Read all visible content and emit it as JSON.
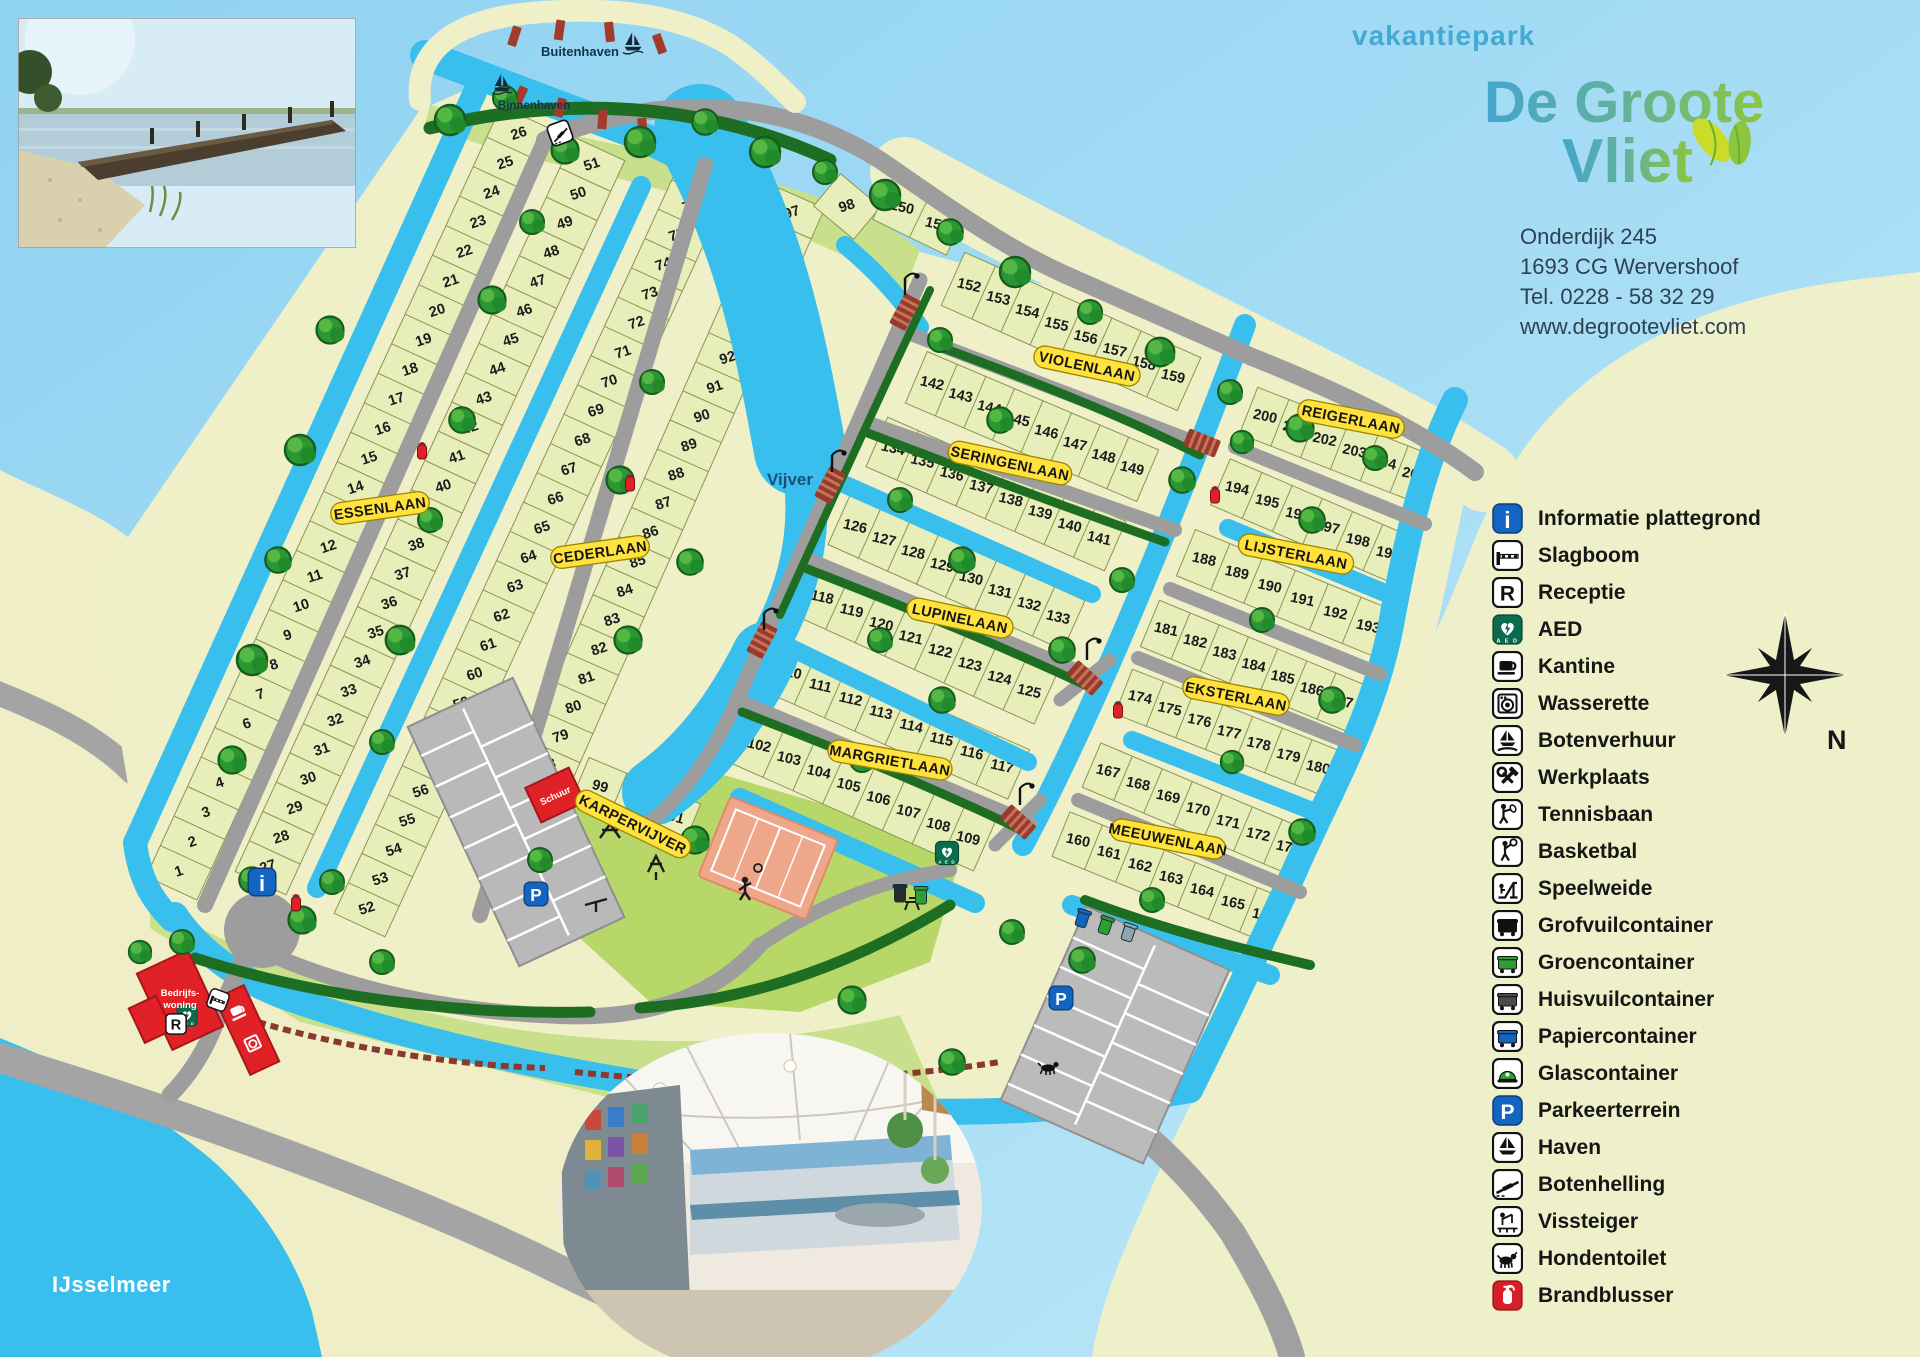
{
  "header": {
    "brand_top": "vakantiepark",
    "brand_line1": "De Groote",
    "brand_line2": "Vliet",
    "address": [
      "Onderdijk 245",
      "1693 CG  Wervershoof",
      "Tel. 0228 - 58 32 29",
      "www.degrootevliet.com"
    ]
  },
  "legend": {
    "compass_label": "N",
    "items": [
      {
        "icon": "info-icon",
        "label": "Informatie plattegrond"
      },
      {
        "icon": "barrier-icon",
        "label": "Slagboom"
      },
      {
        "icon": "reception-icon",
        "label": "Receptie"
      },
      {
        "icon": "aed-icon",
        "label": "AED"
      },
      {
        "icon": "canteen-icon",
        "label": "Kantine"
      },
      {
        "icon": "laundry-icon",
        "label": "Wasserette"
      },
      {
        "icon": "boat-rental-icon",
        "label": "Botenverhuur"
      },
      {
        "icon": "workshop-icon",
        "label": "Werkplaats"
      },
      {
        "icon": "tennis-icon",
        "label": "Tennisbaan"
      },
      {
        "icon": "basketball-icon",
        "label": "Basketbal"
      },
      {
        "icon": "playfield-icon",
        "label": "Speelweide"
      },
      {
        "icon": "bulky-waste-icon",
        "label": "Grofvuilcontainer"
      },
      {
        "icon": "green-container-icon",
        "label": "Groencontainer"
      },
      {
        "icon": "household-waste-icon",
        "label": "Huisvuilcontainer"
      },
      {
        "icon": "paper-container-icon",
        "label": "Papiercontainer"
      },
      {
        "icon": "glass-container-icon",
        "label": "Glascontainer"
      },
      {
        "icon": "parking-icon",
        "label": "Parkeerterrein"
      },
      {
        "icon": "harbor-icon",
        "label": "Haven"
      },
      {
        "icon": "boat-ramp-icon",
        "label": "Botenhelling"
      },
      {
        "icon": "fishing-pier-icon",
        "label": "Vissteiger"
      },
      {
        "icon": "dog-toilet-icon",
        "label": "Hondentoilet"
      },
      {
        "icon": "fire-extinguisher-icon",
        "label": "Brandblusser"
      }
    ]
  },
  "map": {
    "water_labels": {
      "ijsselmeer": "IJsselmeer",
      "vijver": "Vijver",
      "buitenhaven": "Buitenhaven",
      "binnenhaven": "Binnenhaven"
    },
    "buildings": {
      "bedrijfswoning_line1": "Bedrijfs-",
      "bedrijfswoning_line2": "woning",
      "schuur": "Schuur"
    },
    "streets": [
      {
        "id": "essenlaan",
        "name": "ESSENLAAN"
      },
      {
        "id": "cederlaan",
        "name": "CEDERLAAN"
      },
      {
        "id": "karpervijver",
        "name": "KARPERVIJVER"
      },
      {
        "id": "violenlaan",
        "name": "VIOLENLAAN"
      },
      {
        "id": "seringenlaan",
        "name": "SERINGENLAAN"
      },
      {
        "id": "lupinelaan",
        "name": "LUPINELAAN"
      },
      {
        "id": "margrietlaan",
        "name": "MARGRIETLAAN"
      },
      {
        "id": "meeuwenlaan",
        "name": "MEEUWENLAAN"
      },
      {
        "id": "eksterlaan",
        "name": "EKSTERLAAN"
      },
      {
        "id": "lijsterlaan",
        "name": "LIJSTERLAAN"
      },
      {
        "id": "reigerlaan",
        "name": "REIGERLAAN"
      }
    ],
    "lot_blocks": [
      {
        "id": "b1",
        "numbers": [
          1,
          2,
          3,
          4,
          5,
          6,
          7,
          8,
          9,
          10,
          11,
          12,
          13,
          14,
          15,
          16,
          17,
          18,
          19,
          20,
          21,
          22,
          23,
          24,
          25,
          26
        ]
      },
      {
        "id": "b2",
        "numbers": [
          27,
          28,
          29,
          30,
          31,
          32,
          33,
          34,
          35,
          36,
          37,
          38,
          39,
          40,
          41,
          42,
          43,
          44,
          45,
          46,
          47,
          48,
          49,
          50,
          51
        ]
      },
      {
        "id": "b3",
        "numbers": [
          52,
          53,
          54,
          55,
          56,
          57,
          58,
          59,
          60,
          61,
          62,
          63,
          64,
          65,
          66,
          67,
          68,
          69,
          70,
          71,
          72,
          73,
          74,
          75,
          76,
          77
        ]
      },
      {
        "id": "b4",
        "numbers": [
          78,
          79,
          80,
          81,
          82,
          83,
          84,
          85,
          86,
          87,
          88,
          89,
          90,
          91,
          92,
          93,
          94,
          95,
          96,
          97
        ]
      },
      {
        "id": "b4x",
        "numbers": [
          98
        ]
      },
      {
        "id": "b5",
        "numbers": [
          99,
          100,
          101
        ]
      },
      {
        "id": "b6",
        "numbers": [
          150,
          151
        ]
      },
      {
        "id": "b7",
        "numbers": [
          152,
          153,
          154,
          155,
          156,
          157,
          158,
          159
        ]
      },
      {
        "id": "b8",
        "numbers": [
          142,
          143,
          144,
          145,
          146,
          147,
          148,
          149
        ]
      },
      {
        "id": "b9",
        "numbers": [
          134,
          135,
          136,
          137,
          138,
          139,
          140,
          141
        ]
      },
      {
        "id": "b10",
        "numbers": [
          126,
          127,
          128,
          129,
          130,
          131,
          132,
          133
        ]
      },
      {
        "id": "b11",
        "numbers": [
          118,
          119,
          120,
          121,
          122,
          123,
          124,
          125
        ]
      },
      {
        "id": "b12",
        "numbers": [
          110,
          111,
          112,
          113,
          114,
          115,
          116,
          117
        ]
      },
      {
        "id": "b13",
        "numbers": [
          102,
          103,
          104,
          105,
          106,
          107,
          108,
          109
        ]
      },
      {
        "id": "b14",
        "numbers": [
          200,
          201,
          202,
          203,
          204,
          205
        ]
      },
      {
        "id": "b15",
        "numbers": [
          194,
          195,
          196,
          197,
          198,
          199
        ]
      },
      {
        "id": "b16",
        "numbers": [
          188,
          189,
          190,
          191,
          192,
          193
        ]
      },
      {
        "id": "b17",
        "numbers": [
          181,
          182,
          183,
          184,
          185,
          186,
          187
        ]
      },
      {
        "id": "b18",
        "numbers": [
          174,
          175,
          176,
          177,
          178,
          179,
          180
        ]
      },
      {
        "id": "b19",
        "numbers": [
          167,
          168,
          169,
          170,
          171,
          172,
          173
        ]
      },
      {
        "id": "b20",
        "numbers": [
          160,
          161,
          162,
          163,
          164,
          165,
          166
        ]
      }
    ]
  }
}
